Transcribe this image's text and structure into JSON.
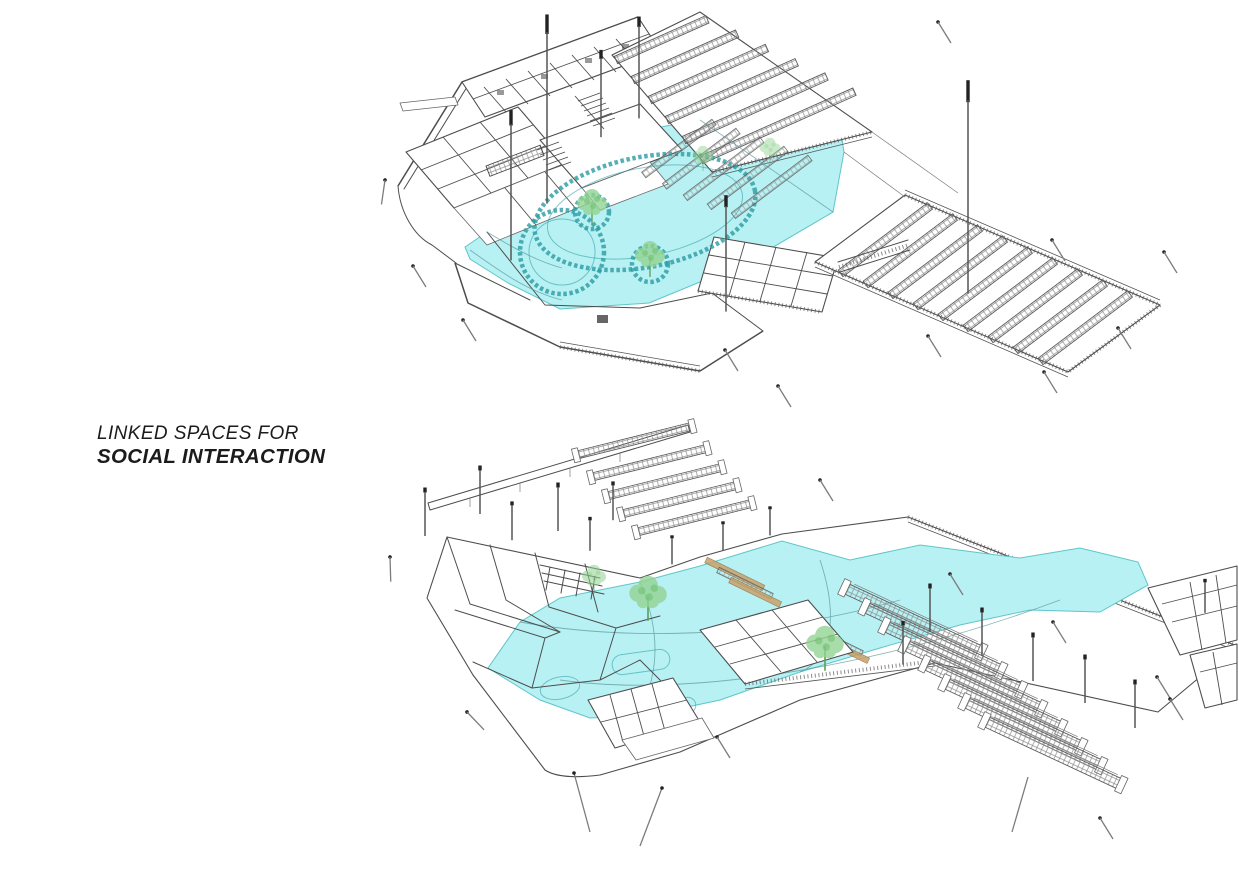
{
  "caption": {
    "line1": "LINKED SPACES FOR",
    "line2": "SOCIAL INTERACTION"
  },
  "colors": {
    "background": "#ffffff",
    "line": "#4d4d4d",
    "highlight": "#b7f1f3",
    "highlight_edge": "#5ec6ca",
    "seat_teal": "#2a9ca2",
    "tree_green": "#93d493",
    "stair_tan": "#c9a06a",
    "pole_cap": "#222222"
  }
}
